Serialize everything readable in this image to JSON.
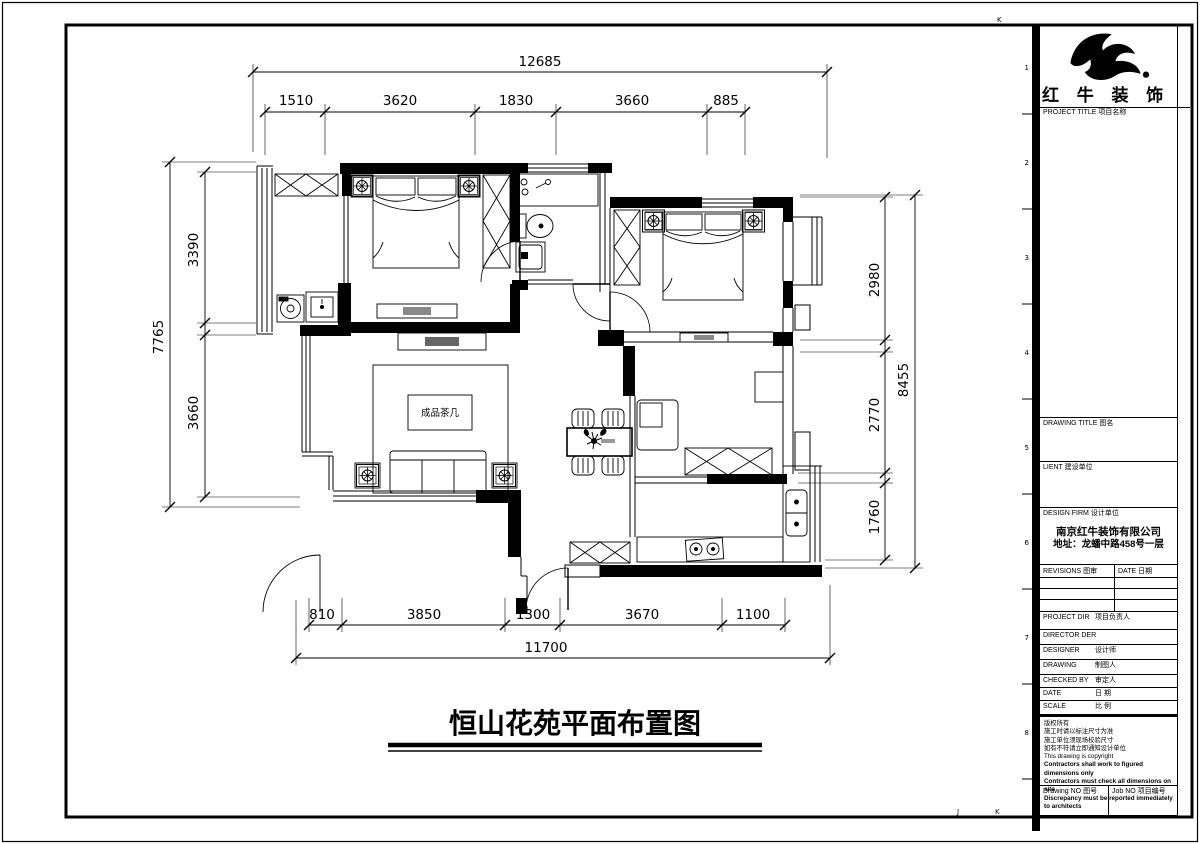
{
  "title": {
    "text": "恒山花苑平面布置图"
  },
  "plan": {
    "tea_table": "成品茶几"
  },
  "dims": {
    "top": {
      "total": "12685",
      "segments": [
        "1510",
        "3620",
        "1830",
        "3660",
        "885"
      ]
    },
    "bottom": {
      "total": "11700",
      "segments": [
        "810",
        "3850",
        "1300",
        "3670",
        "1100"
      ]
    },
    "left": {
      "total": "7765",
      "segments": [
        "3390",
        "3660"
      ]
    },
    "right": {
      "total": "8455",
      "segments": [
        "2980",
        "2770",
        "1760"
      ]
    }
  },
  "sheet": {
    "row_numbers": [
      "1",
      "2",
      "3",
      "4",
      "5",
      "6",
      "7",
      "8"
    ],
    "mark_top": "K",
    "mark_bottom_left": "J",
    "mark_bottom_right": "K"
  },
  "titleblock": {
    "brand": "红 牛 装 饰",
    "project_title": "PROJECT TITLE  项目名称",
    "drawing_title": "DRAWING TITLE  图名",
    "client": "LIENT  建设单位",
    "design_firm": "DESIGN FIRM  设计单位",
    "firm_name": "南京红牛装饰有限公司",
    "firm_address": "地址：龙蟠中路458号一层",
    "revisions": "REVISIONS  图审",
    "date_col": "DATE  日期",
    "rows": [
      {
        "en": "PROJECT DIR",
        "cn": "项目负责人"
      },
      {
        "en": "DIRECTOR DER",
        "cn": ""
      },
      {
        "en": "DESIGNER",
        "cn": "设计师"
      },
      {
        "en": "DRAWING",
        "cn": "制图人"
      },
      {
        "en": "CHECKED BY",
        "cn": "审定人"
      },
      {
        "en": "DATE",
        "cn": "日 期"
      },
      {
        "en": "SCALE",
        "cn": "比 例"
      }
    ],
    "notes": [
      "版权所有",
      "施工时请以标注尺寸为准",
      "施工单位须现场校验尺寸",
      "如有不符请立即通知设计单位",
      "This drawing is copyright"
    ],
    "notes_bold": [
      "Contractors shall work to figured dimensions only",
      "Contractors must check all dimensions on site",
      "Discrepancy must be reported immediately to architects"
    ],
    "drawing_no": "Drawing NO  图号",
    "job_no": "Job NO  项目编号"
  }
}
